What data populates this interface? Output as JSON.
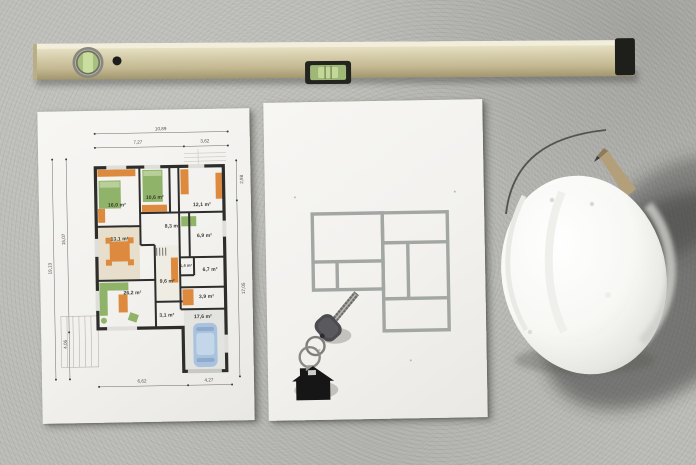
{
  "scene": {
    "objects": [
      "spirit-level",
      "detailed-floor-plan-sheet",
      "outline-floor-plan-sheet",
      "house-keys",
      "house-keychain",
      "hard-hat",
      "carpenter-pencil"
    ]
  },
  "colors": {
    "concrete": "#bcbcb8",
    "paper": "#f5f4f1",
    "level_brass": "#cfc7a3",
    "vial_green": "#b3c98c",
    "plan_wall_dark": "#2d2d2b",
    "furniture_orange": "#dd8a3e",
    "furniture_green": "#8fb369",
    "floor_beige": "#e7dfcc",
    "outline_plan_gray": "#a2a7a4",
    "car_blue": "#a9c3df",
    "hat_white": "#fafaf8",
    "keychain_black": "#161616"
  },
  "plan_detailed": {
    "dims": {
      "top_total": "10,89",
      "top_left": "7,27",
      "top_right": "3,62",
      "left_total": "19,13",
      "left_upper": "15,07",
      "left_lower": "4,06",
      "right_upper": "2,98",
      "right_lower": "17,05",
      "bottom_left": "6,62",
      "bottom_right": "4,27"
    },
    "rooms": [
      {
        "area": "16,0 m²"
      },
      {
        "area": "10,6 m²"
      },
      {
        "area": "12,1 m²"
      },
      {
        "area": "8,3 m²"
      },
      {
        "area": "13,1 m²"
      },
      {
        "area": "6,9 m²"
      },
      {
        "area": "1,4 m²"
      },
      {
        "area": "6,7 m²"
      },
      {
        "area": "26,2 m²"
      },
      {
        "area": "9,6 m²"
      },
      {
        "area": "3,9 m²"
      },
      {
        "area": "3,1 m²"
      },
      {
        "area": "17,6 m²"
      }
    ]
  }
}
